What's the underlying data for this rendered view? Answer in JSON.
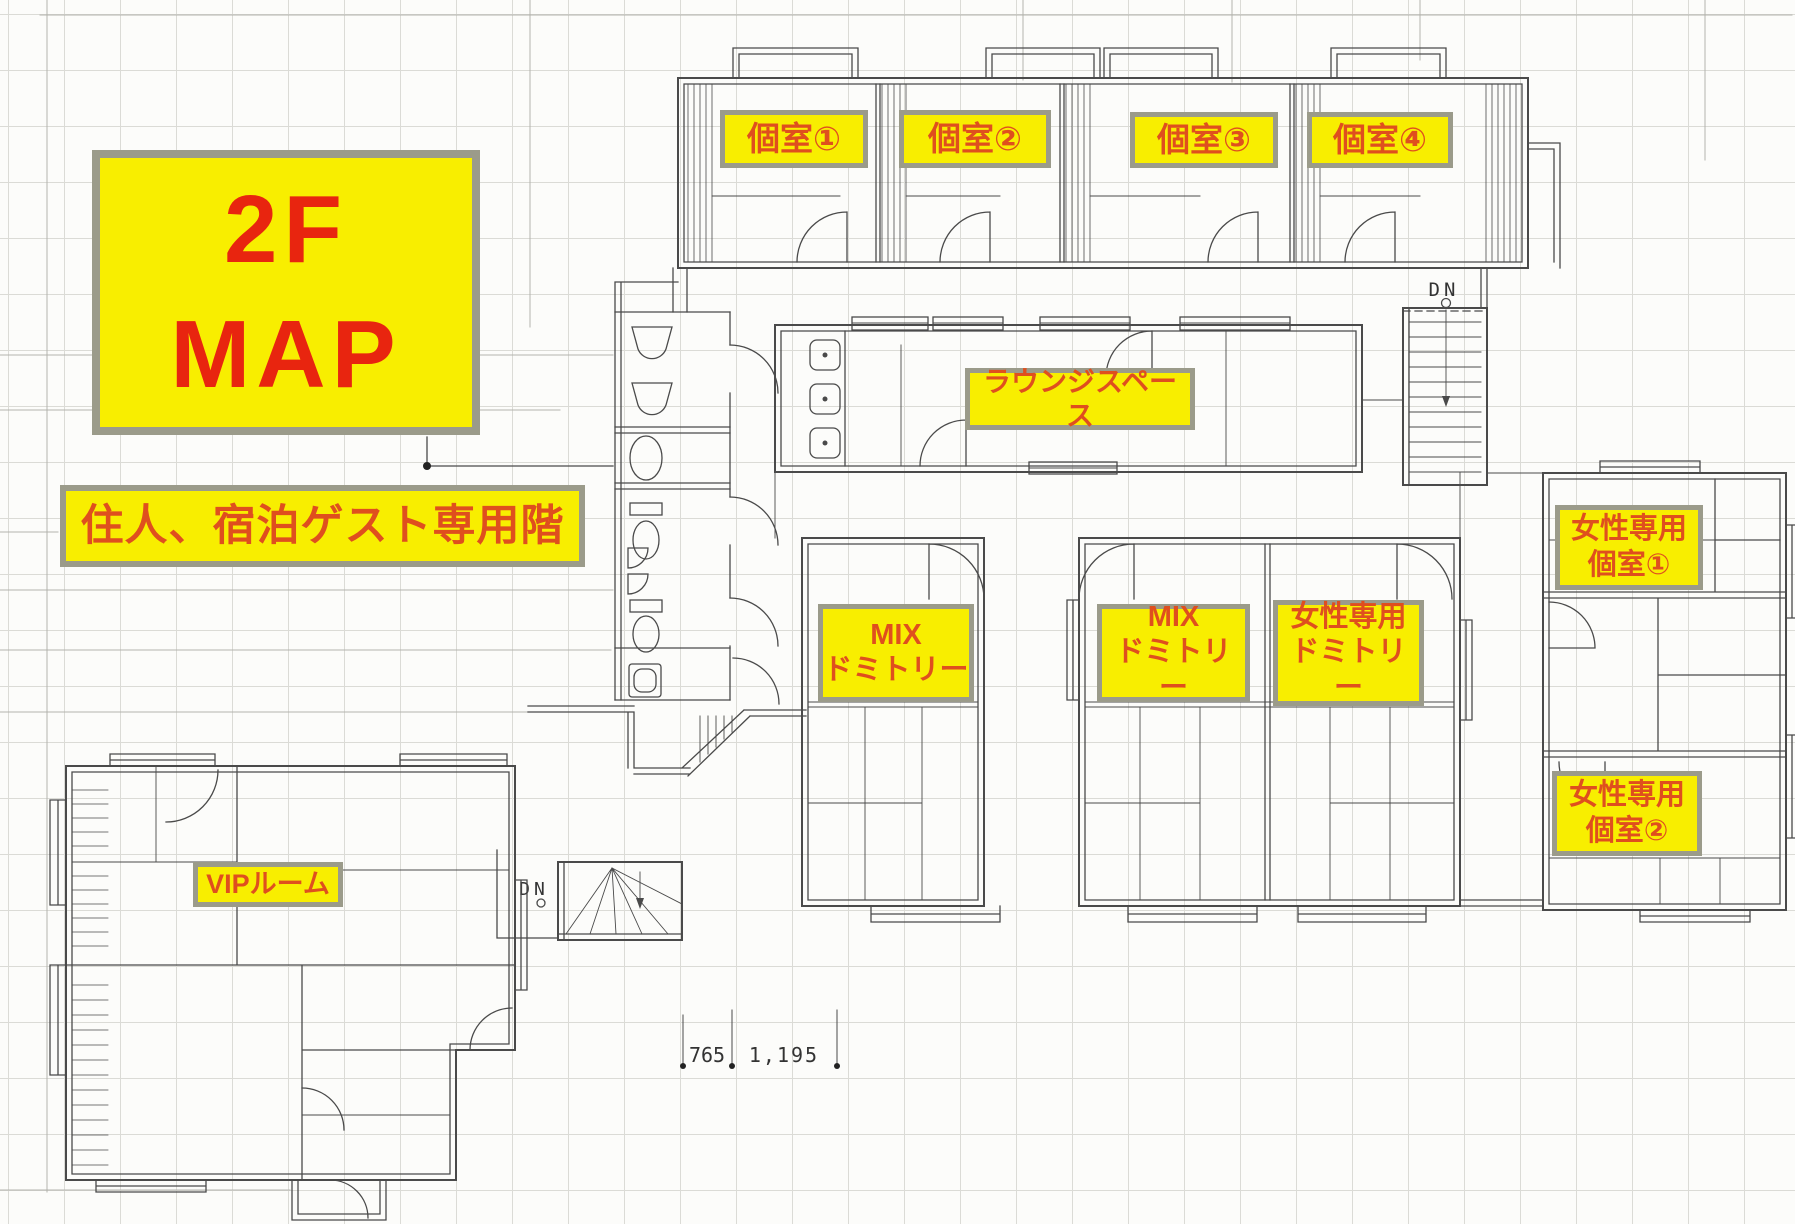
{
  "page": {
    "type": "floor-plan",
    "floor": "2F"
  },
  "legend": {
    "floor_title": "2F\nMAP",
    "floor_note": "住人、宿泊ゲスト専用階"
  },
  "rooms": {
    "private_1": "個室①",
    "private_2": "個室②",
    "private_3": "個室③",
    "private_4": "個室④",
    "lounge": "ラウンジスペース",
    "mix_dorm_a": "MIX\nドミトリー",
    "mix_dorm_b": "MIX\nドミトリー",
    "womens_dorm": "女性専用\nドミトリー",
    "womens_private_1": "女性専用\n個室①",
    "womens_private_2": "女性専用\n個室②",
    "vip": "VIPルーム"
  },
  "markers": {
    "stairs_down": "DN",
    "dim_a": "765",
    "dim_b": "1,195"
  },
  "colors": {
    "label_bg": "#f8ee00",
    "label_border": "#9b9b8a",
    "label_text": "#df4f1e",
    "title_text": "#e8250f",
    "line": "#4a4a4a"
  }
}
